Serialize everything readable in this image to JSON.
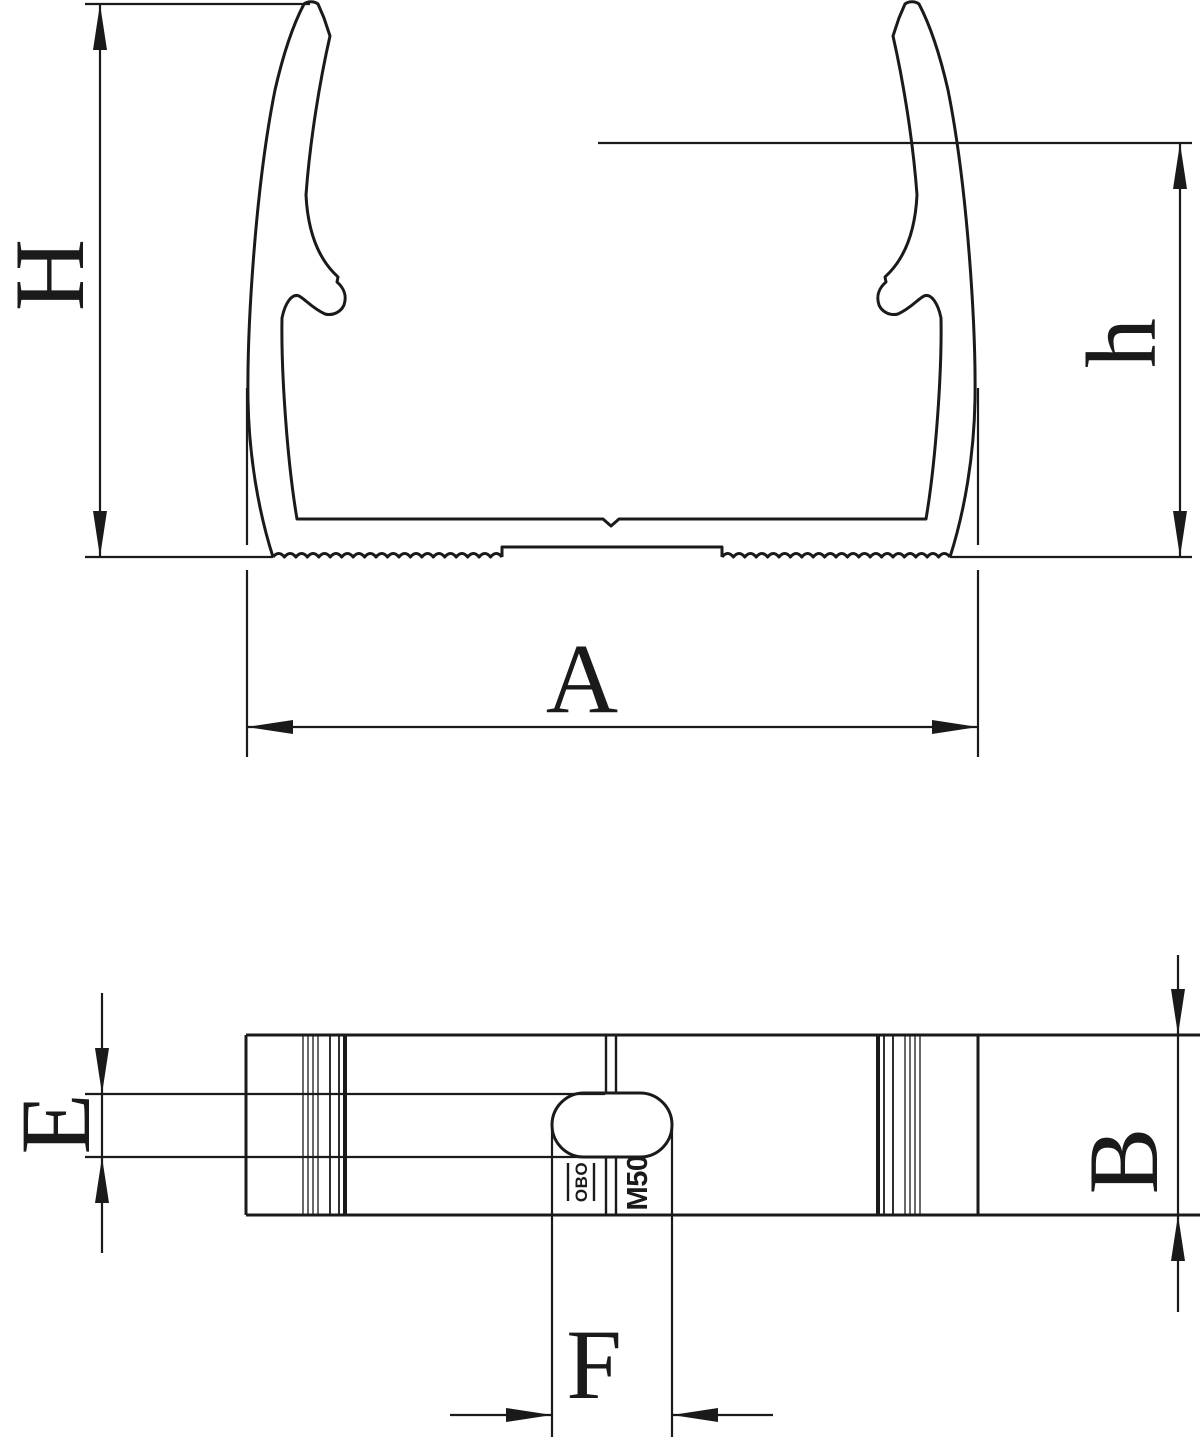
{
  "drawing": {
    "background": "#ffffff",
    "line_color": "#1a1a1a",
    "views": {
      "front_profile": {
        "dimension_labels": {
          "overall_height": "H",
          "inner_height": "h",
          "overall_width": "A"
        }
      },
      "plan": {
        "dimension_labels": {
          "slot_width": "E",
          "depth": "B",
          "slot_length": "F"
        },
        "markings": {
          "logo": "OBO",
          "size_code": "M50"
        }
      }
    }
  }
}
